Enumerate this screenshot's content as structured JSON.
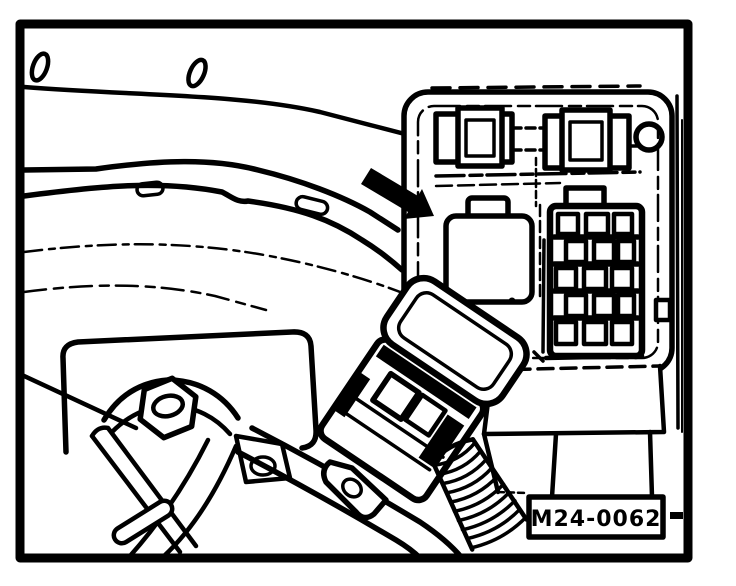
{
  "figure": {
    "reference_label": "M24-0062",
    "ink": "#000000",
    "paper": "#ffffff"
  },
  "parts": [
    "drawing-frame",
    "mounting-slots",
    "body-contour-line",
    "bellhousing-flange-arcs",
    "flange-slot-details",
    "relay-bracket-panel",
    "retaining-clips",
    "screw-hole",
    "empty-relay-socket",
    "multi-pin-connector-block",
    "installation-direction-arrow",
    "relay-connector-housing",
    "hex-bolt",
    "engine-mount-bracket",
    "shift-linkage-rods",
    "linkage-cross-pin",
    "clevis-bracket",
    "corrugated-wiring-conduit",
    "reference-label"
  ]
}
